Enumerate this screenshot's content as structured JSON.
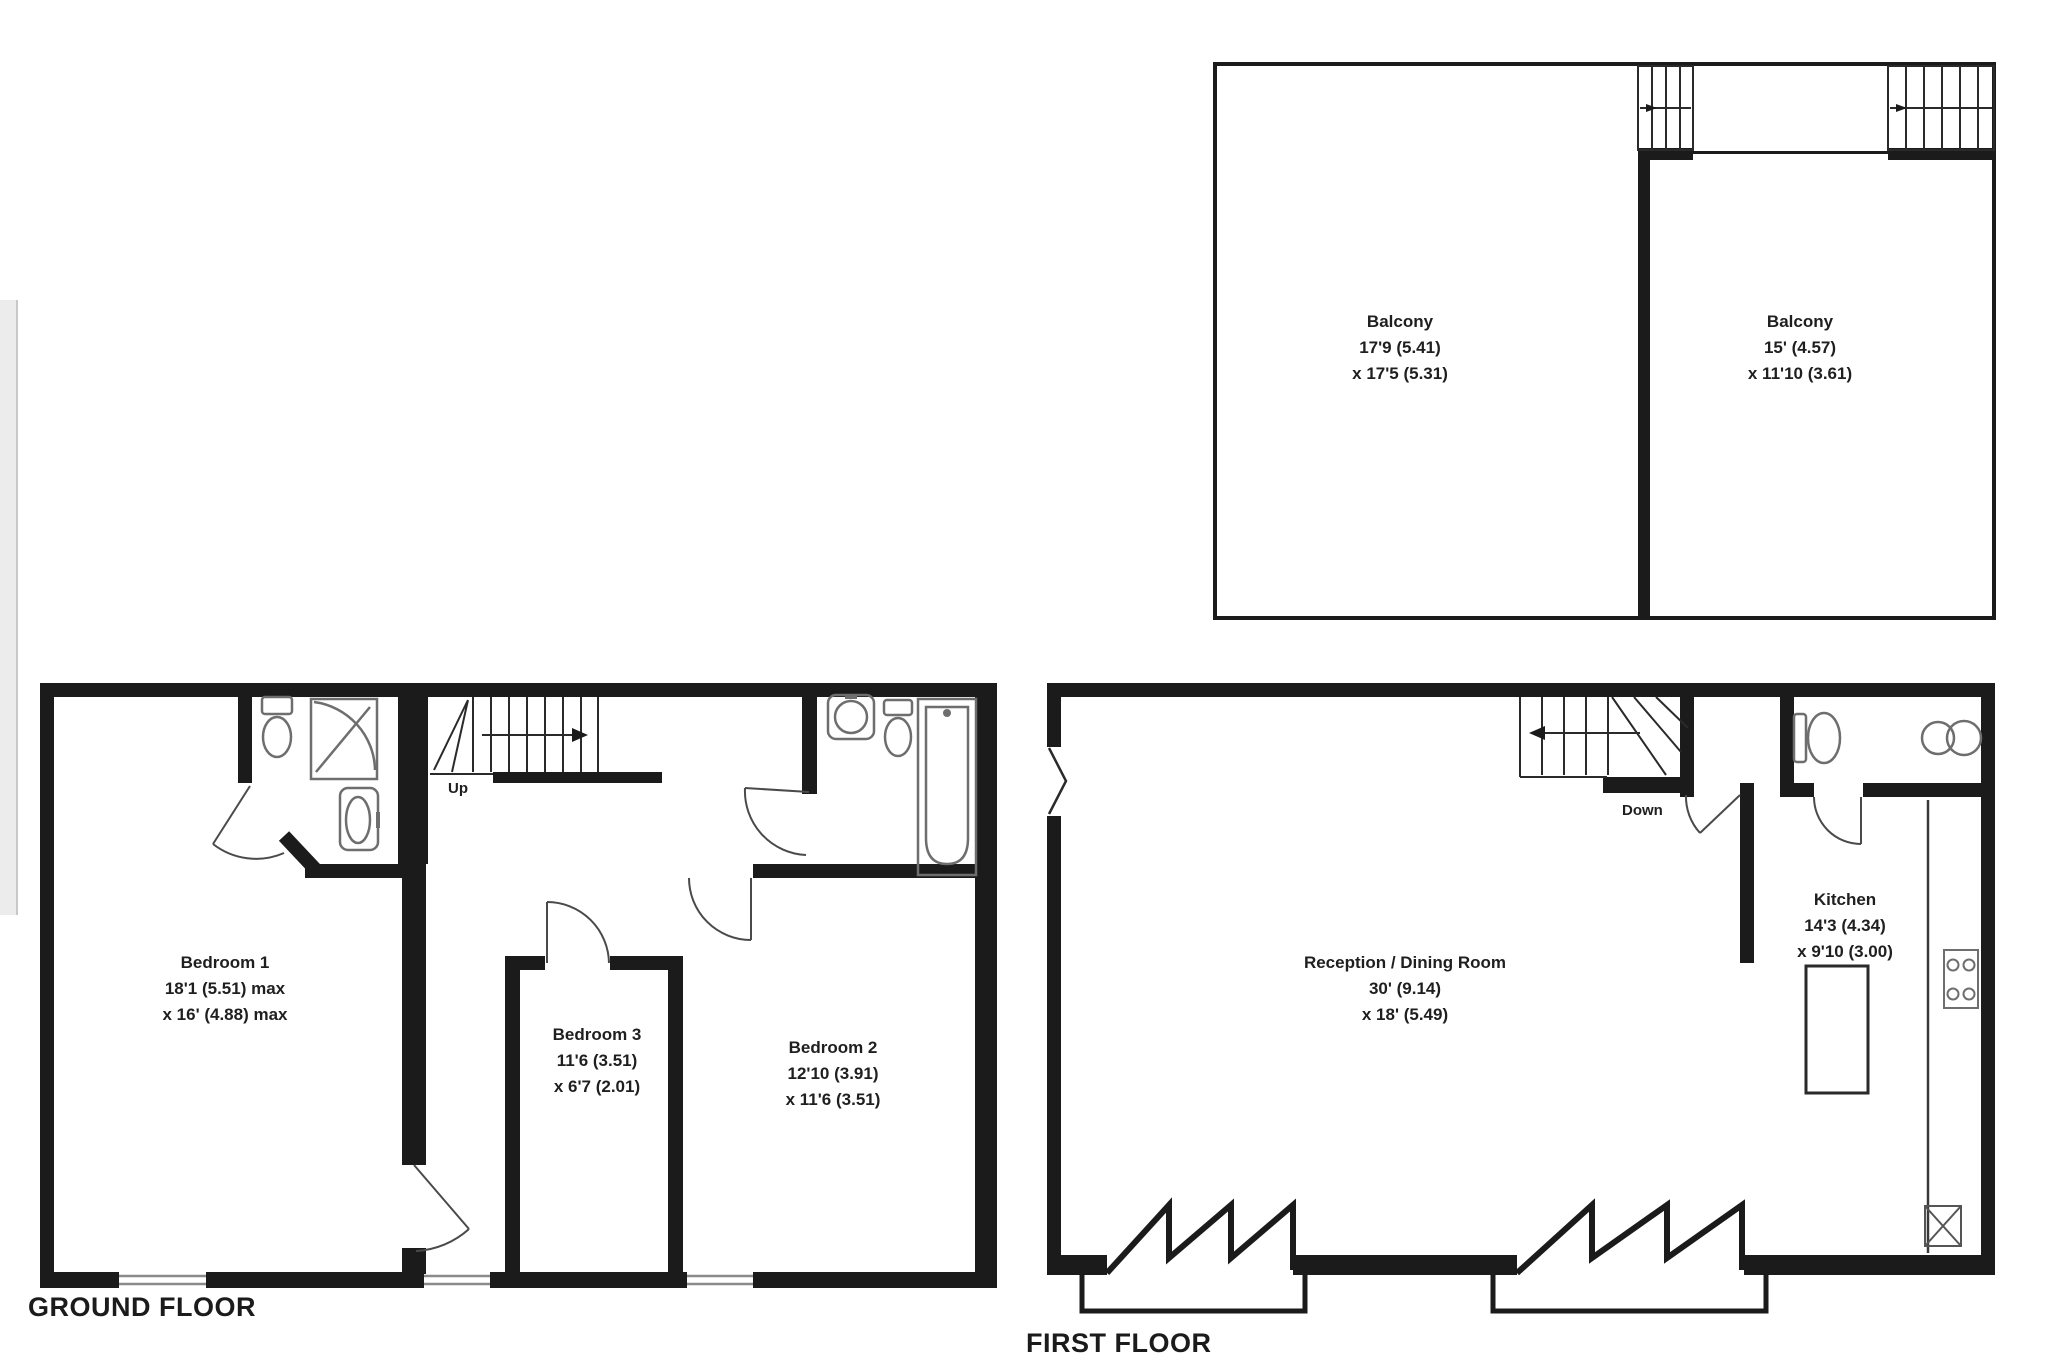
{
  "floor_plan": {
    "ground": {
      "title": "GROUND FLOOR",
      "stairs_label": "Up",
      "rooms": {
        "bedroom1": {
          "name": "Bedroom 1",
          "dims": [
            "18'1 (5.51) max",
            "x 16' (4.88) max"
          ]
        },
        "bedroom3": {
          "name": "Bedroom 3",
          "dims": [
            "11'6 (3.51)",
            "x 6'7 (2.01)"
          ]
        },
        "bedroom2": {
          "name": "Bedroom 2",
          "dims": [
            "12'10 (3.91)",
            "x 11'6 (3.51)"
          ]
        }
      }
    },
    "first": {
      "title": "FIRST FLOOR",
      "stairs_label": "Down",
      "rooms": {
        "reception": {
          "name": "Reception / Dining Room",
          "dims": [
            "30' (9.14)",
            "x 18' (5.49)"
          ]
        },
        "kitchen": {
          "name": "Kitchen",
          "dims": [
            "14'3 (4.34)",
            "x 9'10 (3.00)"
          ]
        }
      }
    },
    "balcony_level": {
      "rooms": {
        "balcony_left": {
          "name": "Balcony",
          "dims": [
            "17'9 (5.41)",
            "x 17'5 (5.31)"
          ]
        },
        "balcony_right": {
          "name": "Balcony",
          "dims": [
            "15' (4.57)",
            "x 11'10 (3.61)"
          ]
        }
      }
    },
    "colors": {
      "wall": "#1b1b1b",
      "line": "#3a3a3a",
      "fixture": "#6e6e6e",
      "text": "#1f1f1f"
    }
  }
}
